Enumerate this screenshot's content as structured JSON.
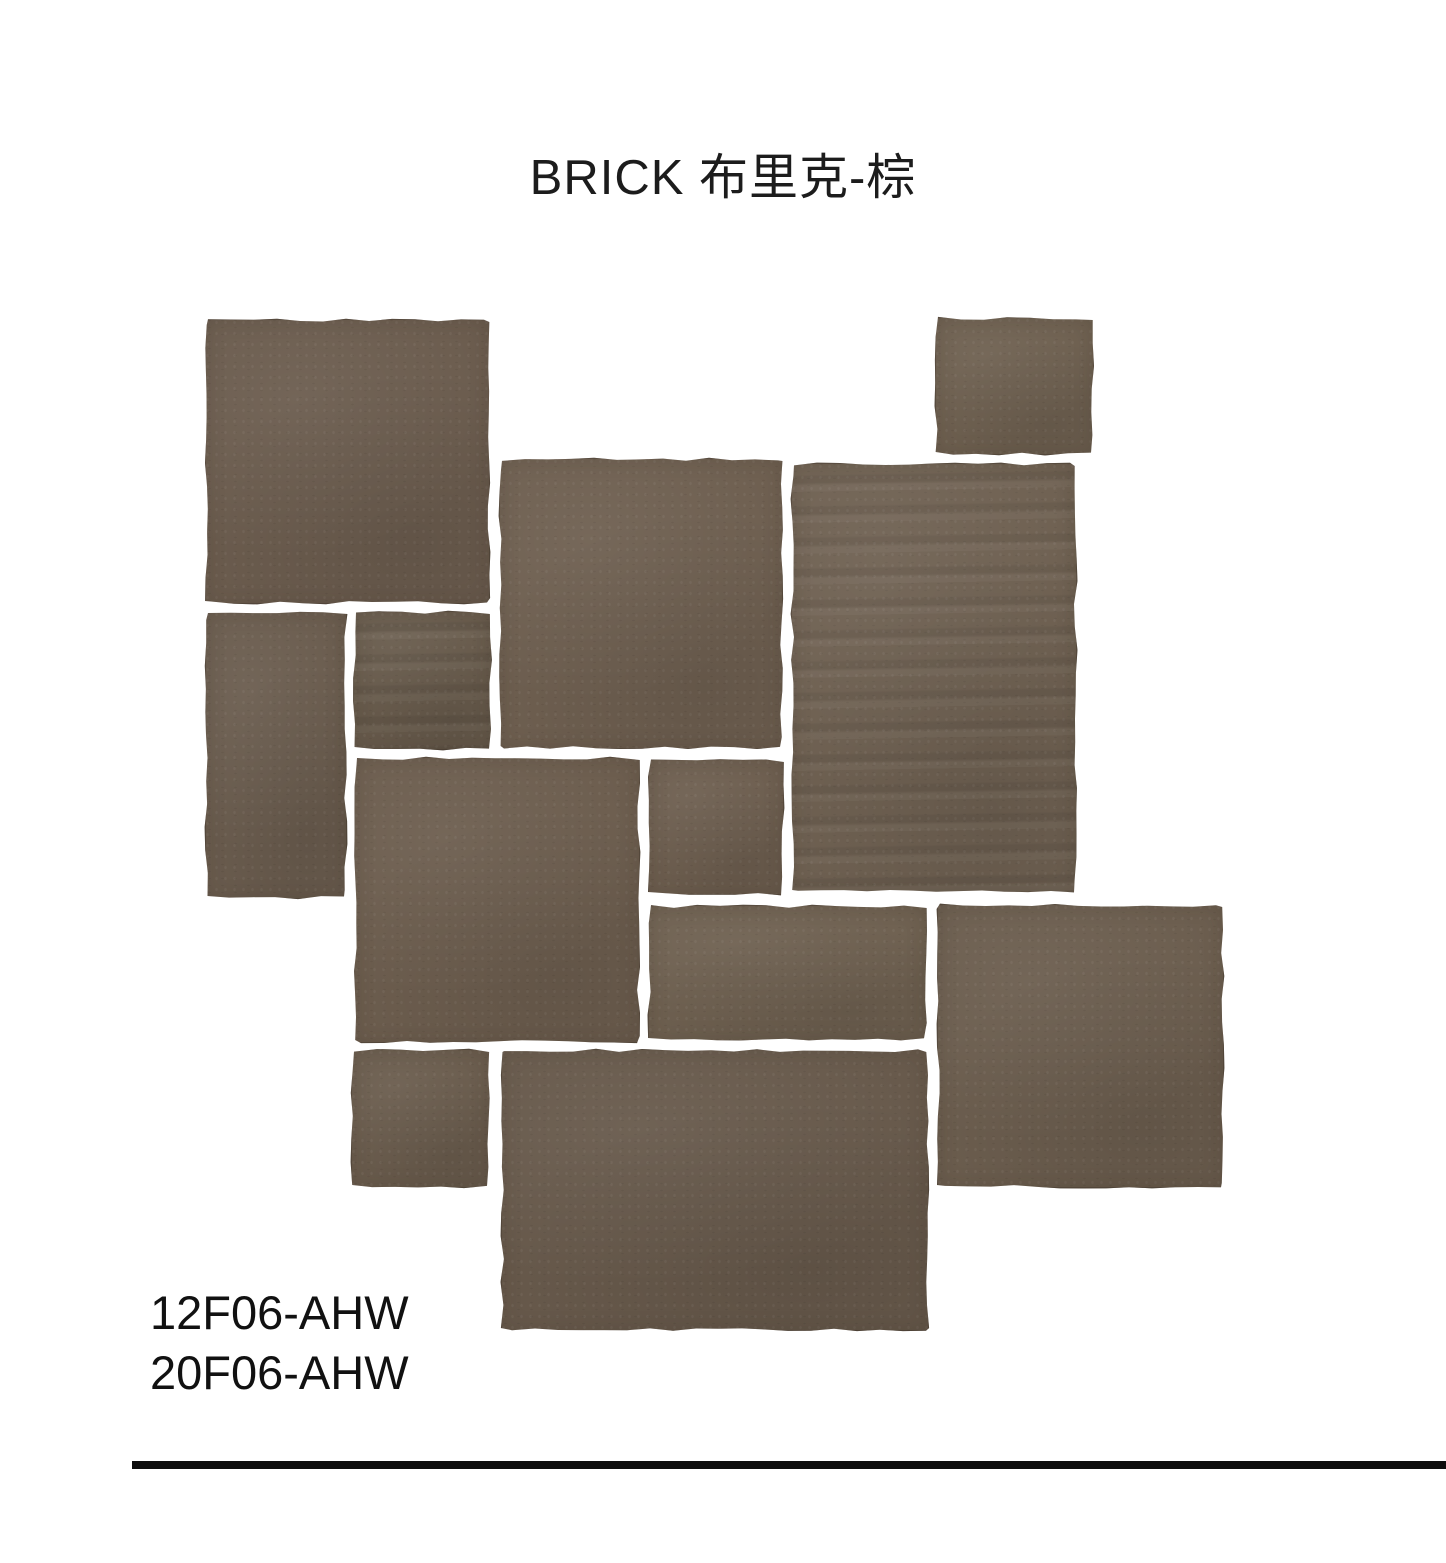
{
  "header": {
    "title": "BRICK 布里克-棕"
  },
  "product_codes": [
    "12F06-AHW",
    "20F06-AHW"
  ],
  "divider": {
    "color": "#0d0d0d"
  },
  "collage": {
    "description": "French-pattern layout of brown rustic brick tiles with irregular hand-chipped edges on white background",
    "grout_color": "#ffffff",
    "edge_color": "#45382c",
    "tiles": [
      {
        "id": "tile-large-square-top-left",
        "shape": "large-square",
        "color": "#6b5c4e"
      },
      {
        "id": "tile-small-rect-top-right",
        "shape": "small-rect",
        "color": "#6e6050"
      },
      {
        "id": "tile-large-square-upper-center",
        "shape": "large-square",
        "color": "#6e5f50"
      },
      {
        "id": "tile-tall-rect-right",
        "shape": "tall-rect",
        "color": "#6f6152",
        "streaky": true
      },
      {
        "id": "tile-tall-rect-left",
        "shape": "tall-narrow-rect",
        "color": "#6a5c4e"
      },
      {
        "id": "tile-small-square-upper",
        "shape": "small-square",
        "color": "#685b4c",
        "streaky": true
      },
      {
        "id": "tile-large-square-center",
        "shape": "large-square",
        "color": "#6c5d4e"
      },
      {
        "id": "tile-small-square-center",
        "shape": "small-square",
        "color": "#6d5e4f"
      },
      {
        "id": "tile-wide-rect-center",
        "shape": "wide-rect",
        "color": "#6e6050"
      },
      {
        "id": "tile-large-square-right",
        "shape": "large-square",
        "color": "#6b5d4e"
      },
      {
        "id": "tile-small-square-lower-left",
        "shape": "small-square",
        "color": "#6a5c4d"
      },
      {
        "id": "tile-large-wide-rect-bottom",
        "shape": "large-wide-rect",
        "color": "#67594b"
      }
    ]
  }
}
